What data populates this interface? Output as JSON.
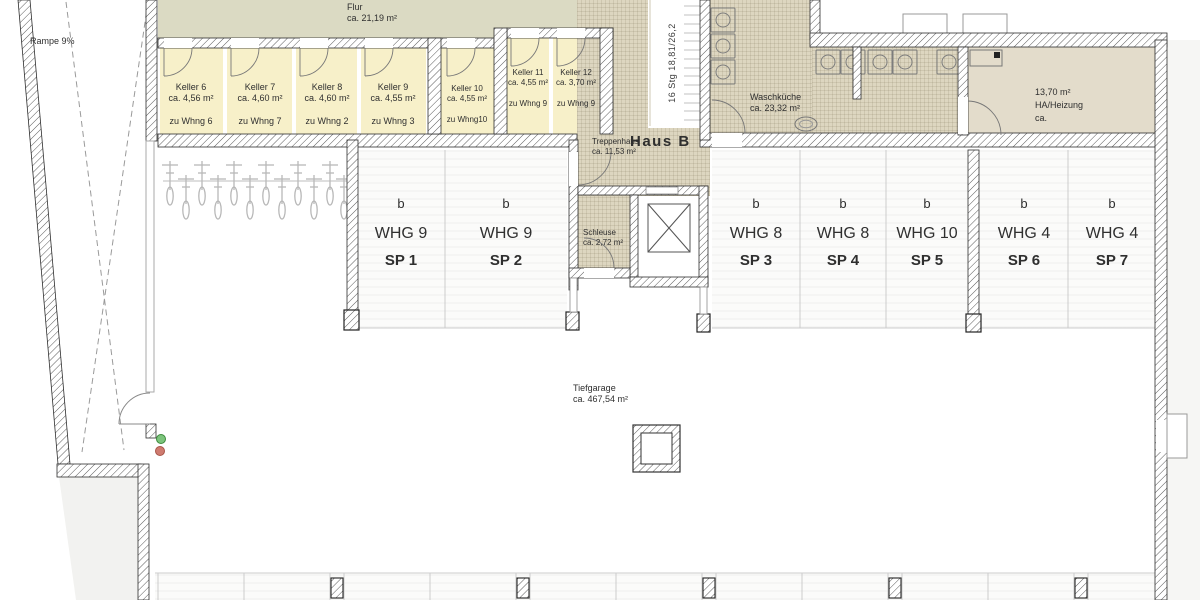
{
  "colors": {
    "flur_fill": "#dbdac3",
    "keller_fill": "#f7f0c9",
    "tile_fill": "#ddd6c0",
    "ha_fill": "#e3dccb",
    "parking_fill": "#fbfbfa",
    "exterior_fill": "#f2f2f0",
    "text_color": "#2f2f2f",
    "divider_line": "#cccccc",
    "traffic_green": "#7cc47c",
    "traffic_red": "#cf7b70"
  },
  "plan": {
    "ramp": {
      "label": "Rampe 9%"
    },
    "flur": {
      "name": "Flur",
      "area": "ca. 21,19 m²"
    },
    "kellers": [
      {
        "name": "Keller 6",
        "area": "ca. 4,56 m²",
        "assign": "zu Whng 6"
      },
      {
        "name": "Keller 7",
        "area": "ca. 4,60 m²",
        "assign": "zu Whng 7"
      },
      {
        "name": "Keller 8",
        "area": "ca. 4,60 m²",
        "assign": "zu Whng 2"
      },
      {
        "name": "Keller 9",
        "area": "ca. 4,55 m²",
        "assign": "zu Whng 3"
      },
      {
        "name": "Keller 10",
        "area": "ca. 4,55 m²",
        "assign": "zu Whng10"
      },
      {
        "name": "Keller 11",
        "area": "ca. 4,55 m²",
        "assign": "zu Whng 9"
      },
      {
        "name": "Keller 12",
        "area": "ca. 3,70 m²",
        "assign": "zu Whng 9"
      }
    ],
    "stairs": {
      "note": "16 Stg 18,81/26,2"
    },
    "house": {
      "label": "Haus B"
    },
    "treppenhaus": {
      "name": "Treppenhaus",
      "area": "ca. 11,53 m²"
    },
    "schleuse": {
      "name": "Schleuse",
      "area": "ca. 2,72 m²"
    },
    "waschkueche": {
      "name": "Waschküche",
      "area": "ca. 23,32 m²"
    },
    "heizung": {
      "area": "13,70 m²",
      "name": "HA/Heizung",
      "suffix": "ca."
    },
    "tiefgarage": {
      "name": "Tiefgarage",
      "area": "ca. 467,54 m²"
    },
    "parking_spots": [
      {
        "marker": "b",
        "unit": "WHG 9",
        "spot": "SP 1"
      },
      {
        "marker": "b",
        "unit": "WHG 9",
        "spot": "SP 2"
      },
      {
        "marker": "b",
        "unit": "WHG 8",
        "spot": "SP 3"
      },
      {
        "marker": "b",
        "unit": "WHG 8",
        "spot": "SP 4"
      },
      {
        "marker": "b",
        "unit": "WHG 10",
        "spot": "SP 5"
      },
      {
        "marker": "b",
        "unit": "WHG 4",
        "spot": "SP 6"
      },
      {
        "marker": "b",
        "unit": "WHG 4",
        "spot": "SP 7"
      }
    ],
    "symbols": {
      "bike_rack": {
        "icon": "bicycle-front-icon",
        "count": 12
      },
      "washing_machines": {
        "icon": "washing-machine-icon",
        "count": 8
      },
      "sink": {
        "icon": "sink-icon"
      },
      "elevator": {
        "icon": "elevator-shaft-icon"
      },
      "traffic_light": {
        "icon": "traffic-light-icon"
      },
      "garage_door": {
        "icon": "garage-door-icon"
      }
    }
  }
}
